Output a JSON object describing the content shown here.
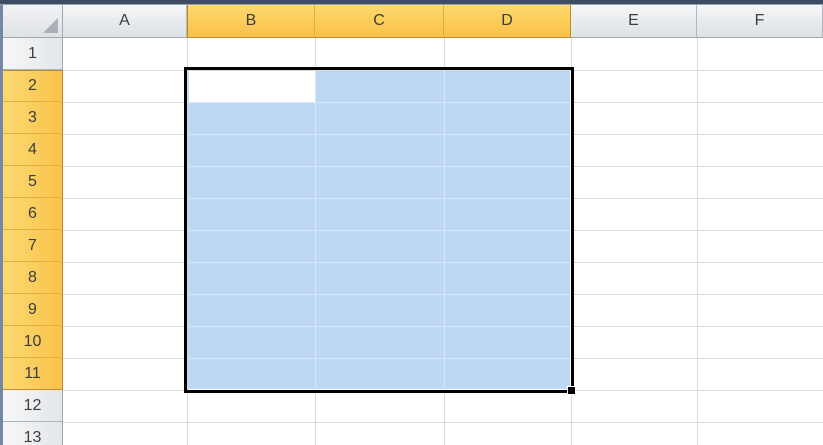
{
  "sheet": {
    "select_all_corner": "select-all",
    "column_headers": [
      "A",
      "B",
      "C",
      "D",
      "E",
      "F"
    ],
    "selected_columns": [
      "B",
      "C",
      "D"
    ],
    "row_headers": [
      "1",
      "2",
      "3",
      "4",
      "5",
      "6",
      "7",
      "8",
      "9",
      "10",
      "11",
      "12",
      "13"
    ],
    "selected_rows": [
      2,
      3,
      4,
      5,
      6,
      7,
      8,
      9,
      10,
      11
    ],
    "selection": {
      "range": "B2:D11",
      "active_cell": "B2"
    }
  },
  "colors": {
    "header_selected": "#F9C24A",
    "header_unselected": "#E3E6E9",
    "selection_fill": "#BDD8F5",
    "selection_inner_gridline": "#D9E6F8",
    "selection_border": "#000000",
    "gridline": "#D9D9D9",
    "top_edge": "#3E4D61",
    "left_edge": "#7288A3"
  }
}
